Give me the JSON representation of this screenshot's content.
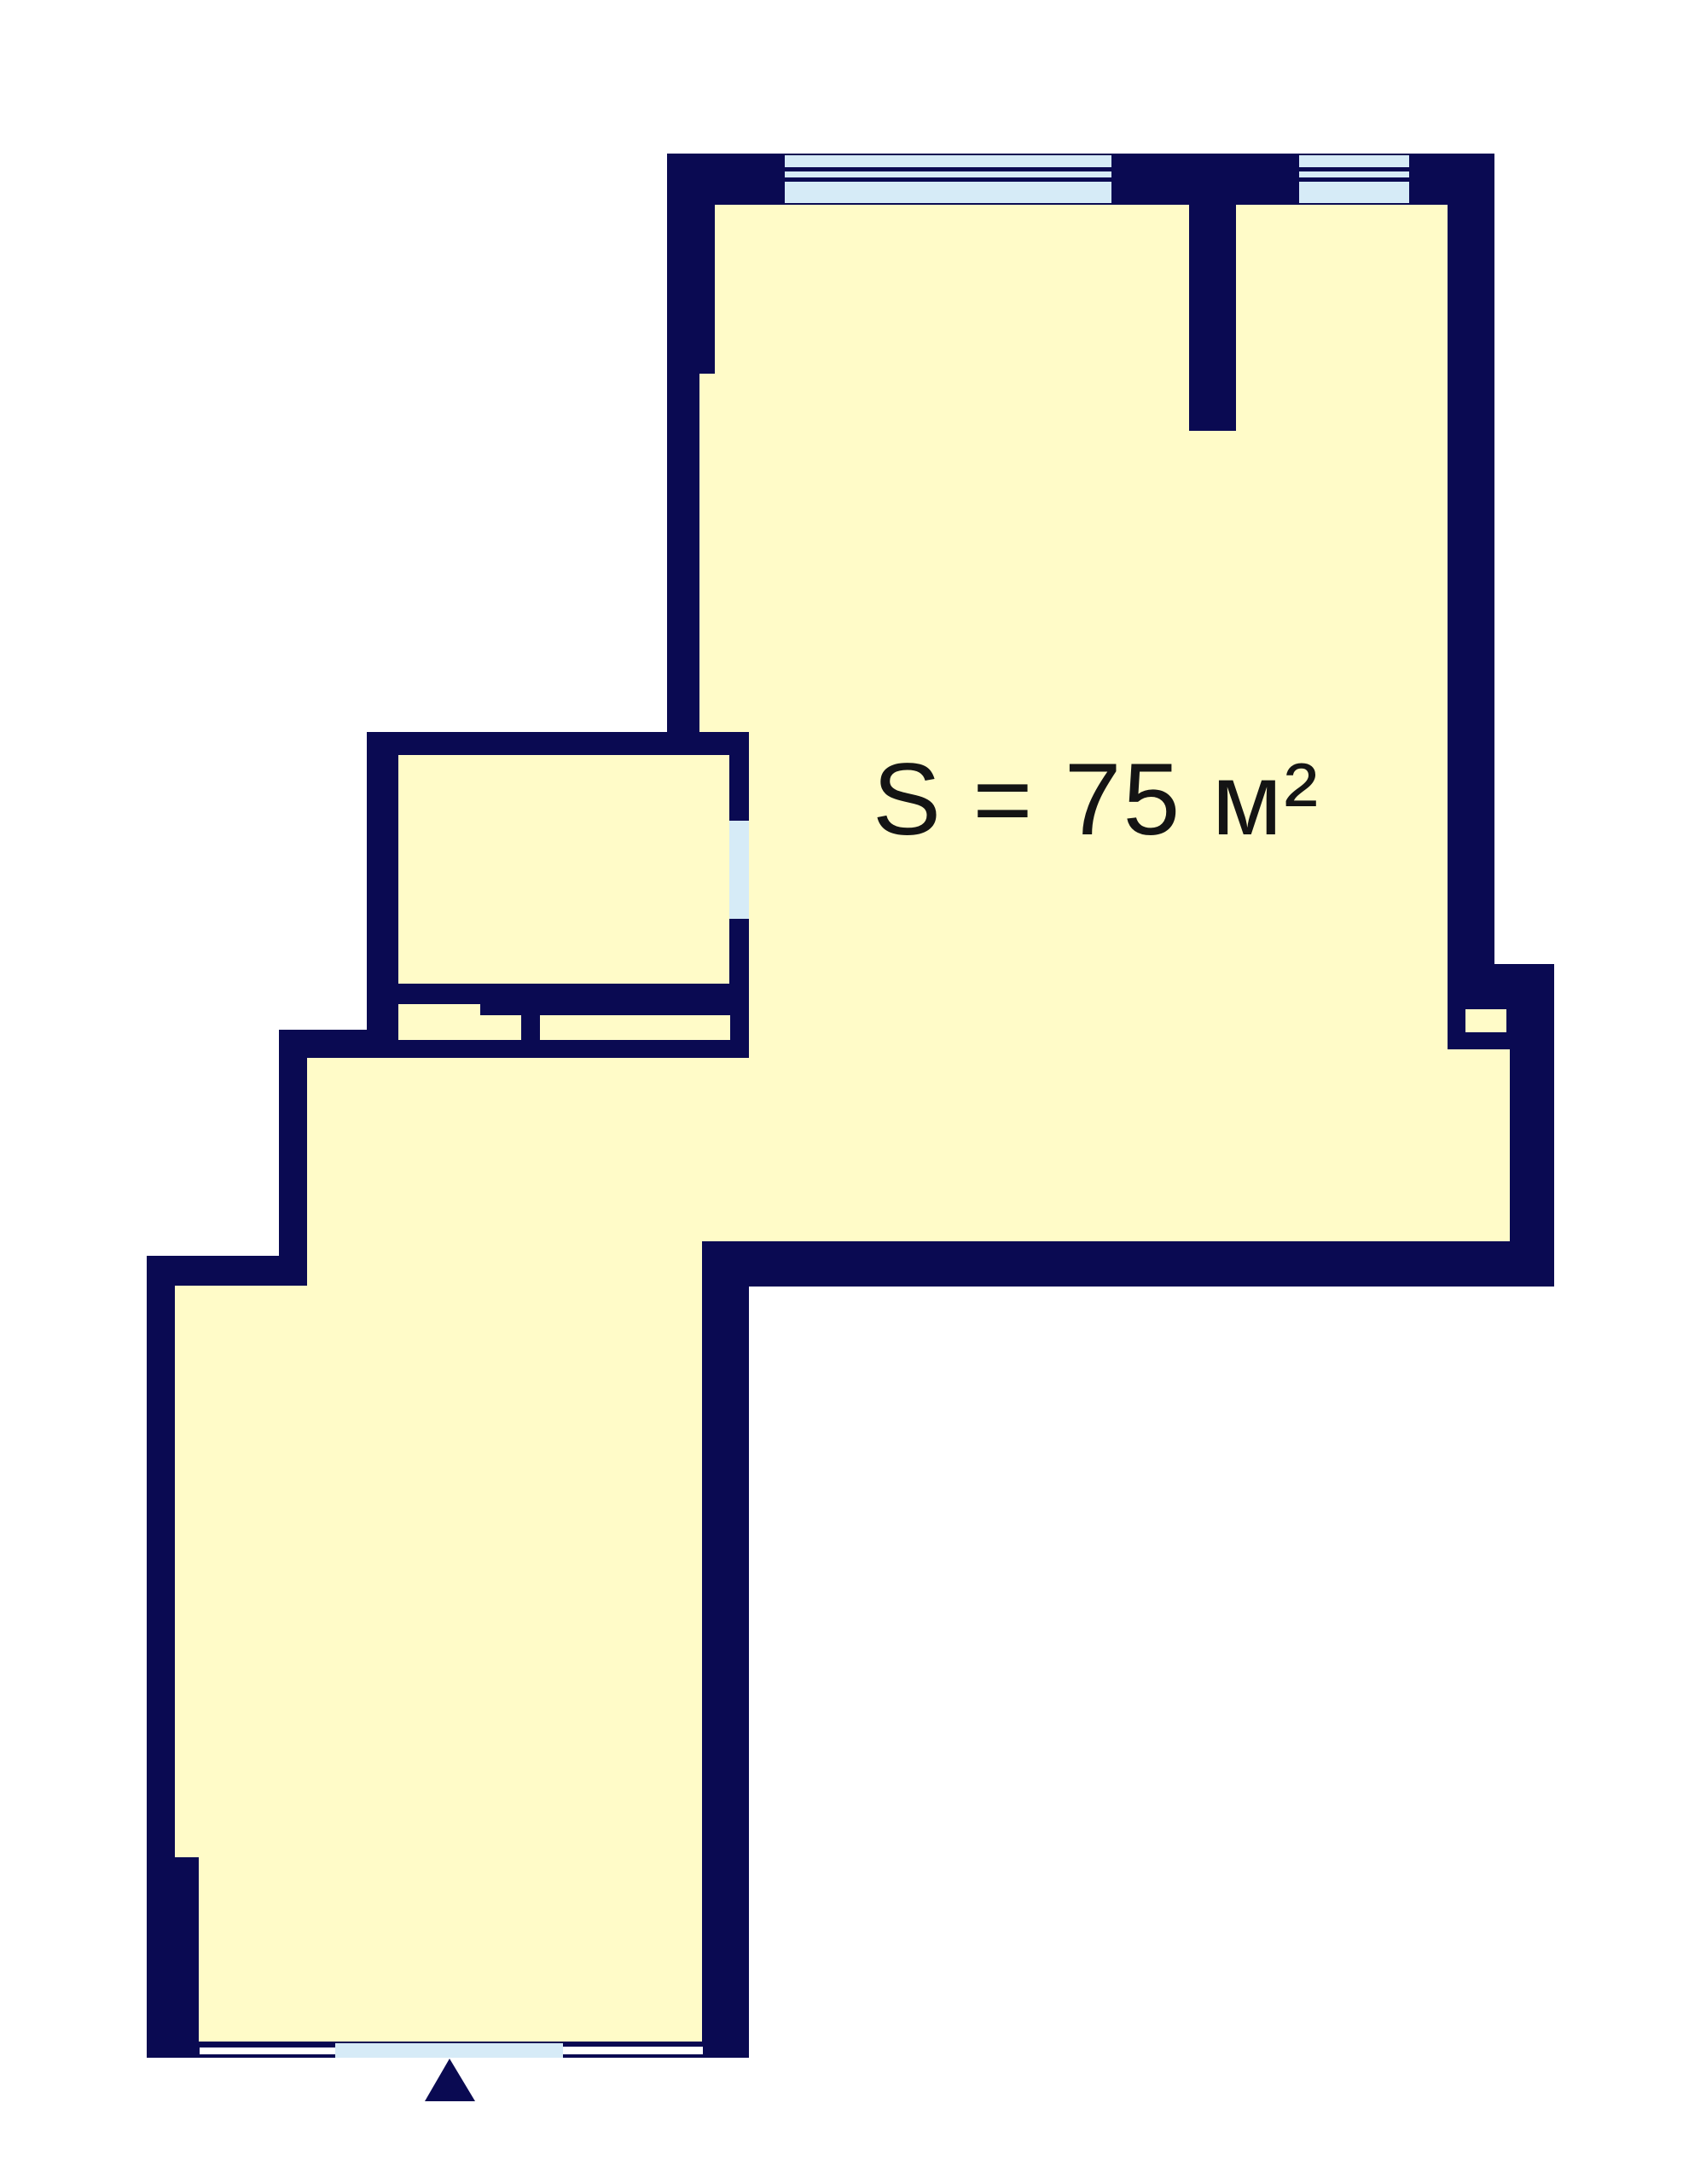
{
  "floor_plan": {
    "area_label": "S = 75 м²",
    "colors": {
      "wall": "#0a0a52",
      "floor": "#fffbc8",
      "window": "#d6ebf7",
      "background": "#ffffff",
      "label_text": "#141414"
    }
  }
}
